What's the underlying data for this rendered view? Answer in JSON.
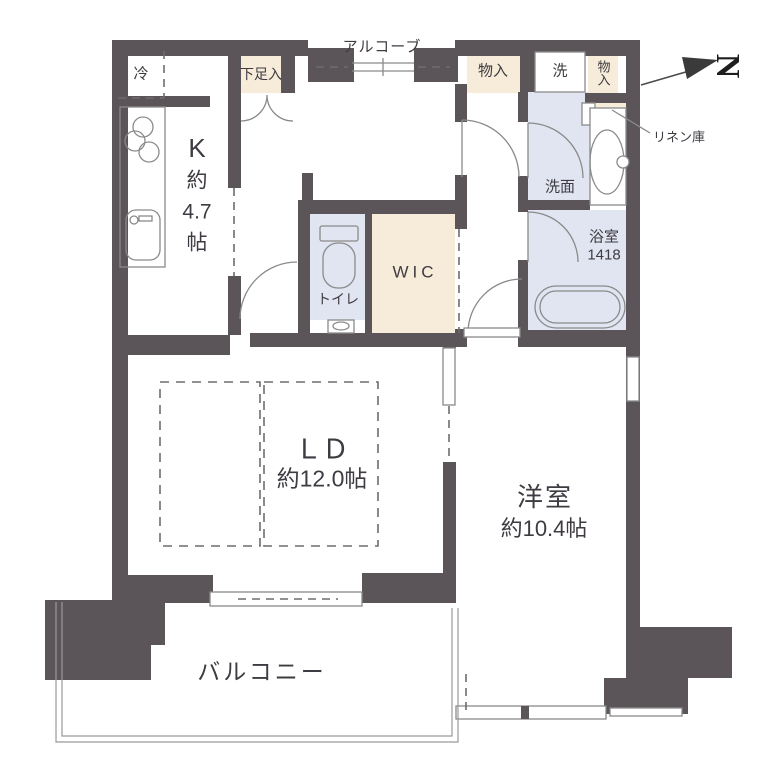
{
  "title": "マンション間取り図",
  "colors": {
    "wall": "#5b5458",
    "beige": "#f6ecd9",
    "blue": "#e0e5f1",
    "line": "#8a8a8a",
    "text": "#3f3b42",
    "dash": "#6d6d6d"
  },
  "labels": {
    "fridge": "冷",
    "kitchen_lines": [
      "K",
      "約",
      "4.7",
      "帖"
    ],
    "shoe_cabinet": "下足入",
    "alcove": "アルコーブ",
    "closet_left": "物入",
    "washer": "洗",
    "closet_right": "物入",
    "linen": "リネン庫",
    "washroom": "洗面",
    "bath_name": "浴室",
    "bath_size": "1418",
    "toilet": "トイレ",
    "wic": "WIC",
    "ld_name": "ＬＤ",
    "ld_size": "約12.0帖",
    "western_name": "洋室",
    "western_size": "約10.4帖",
    "balcony": "バルコニー",
    "north": "N"
  }
}
